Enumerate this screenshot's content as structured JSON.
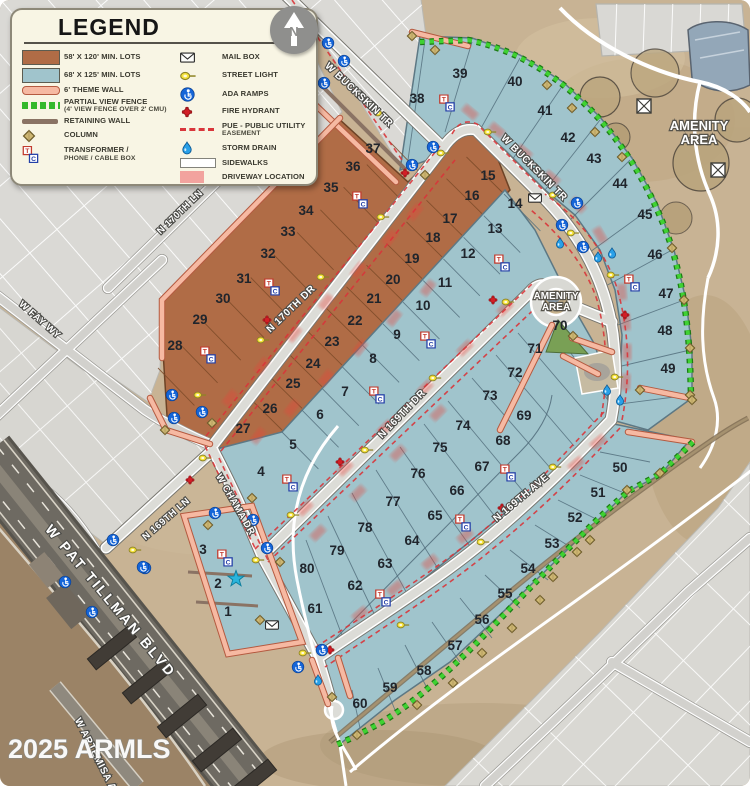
{
  "legend": {
    "title": "LEGEND",
    "left_items": [
      {
        "icon": "brown-swatch",
        "label": "58' X 120' MIN. LOTS"
      },
      {
        "icon": "blue-swatch",
        "label": "68' X 125' MIN. LOTS"
      },
      {
        "icon": "theme-wall",
        "label": "6' THEME WALL"
      },
      {
        "icon": "view-fence",
        "label": "PARTIAL VIEW FENCE",
        "label2": "(4' VIEW FENCE OVER 2' CMU)"
      },
      {
        "icon": "retaining-wall",
        "label": "RETAINING WALL"
      },
      {
        "icon": "column",
        "label": "COLUMN"
      },
      {
        "icon": "transformer-box",
        "label": "TRANSFORMER /",
        "label2": "PHONE / CABLE BOX"
      }
    ],
    "right_items": [
      {
        "icon": "mail-box",
        "label": "MAIL BOX"
      },
      {
        "icon": "street-light",
        "label": "STREET LIGHT"
      },
      {
        "icon": "ada-ramp",
        "label": "ADA RAMPS"
      },
      {
        "icon": "fire-hydrant",
        "label": "FIRE HYDRANT"
      },
      {
        "icon": "pue-dash",
        "label": "PUE - PUBLIC UTILITY",
        "label2": "EASEMENT"
      },
      {
        "icon": "storm-drain",
        "label": "STORM DRAIN"
      },
      {
        "icon": "sidewalks",
        "label": "SIDEWALKS"
      },
      {
        "icon": "driveway",
        "label": "DRIVEWAY LOCATION"
      }
    ]
  },
  "north": {
    "label": "N"
  },
  "watermark": {
    "text": "2025 ARMLS"
  },
  "map": {
    "street_labels": [
      {
        "text": "W BUCKSKIN TR",
        "x": 357,
        "y": 97,
        "rot": 43,
        "size": 10
      },
      {
        "text": "W BUCKSKIN TR",
        "x": 532,
        "y": 170,
        "rot": 45,
        "size": 10
      },
      {
        "text": "N 170TH LN",
        "x": 182,
        "y": 214,
        "rot": -44,
        "size": 9.5
      },
      {
        "text": "W FAY WY",
        "x": 38,
        "y": 322,
        "rot": 41,
        "size": 9.5
      },
      {
        "text": "N 170TH DR",
        "x": 293,
        "y": 311,
        "rot": -44,
        "size": 10
      },
      {
        "text": "N 169TH DR",
        "x": 404,
        "y": 416,
        "rot": -46,
        "size": 10
      },
      {
        "text": "N 169TH AVE",
        "x": 523,
        "y": 500,
        "rot": -40,
        "size": 10
      },
      {
        "text": "N 169TH LN",
        "x": 168,
        "y": 521,
        "rot": -41,
        "size": 9.5
      },
      {
        "text": "W CHAMA DR",
        "x": 233,
        "y": 506,
        "rot": 60,
        "size": 9.5
      },
      {
        "text": "W PAT TILLMAN BLVD",
        "x": 107,
        "y": 604,
        "rot": 50,
        "size": 14,
        "spacing": 2.5
      },
      {
        "text": "W ARTEMISA AVE",
        "x": 96,
        "y": 762,
        "rot": 63,
        "size": 10
      }
    ],
    "area_labels": [
      {
        "line1": "AMENITY",
        "line2": "AREA",
        "x": 699,
        "y": 130,
        "size": 13
      },
      {
        "line1": "AMENITY",
        "line2": "AREA",
        "x": 556,
        "y": 299,
        "size": 10
      }
    ],
    "lots": [
      {
        "n": "1",
        "x": 228,
        "y": 616
      },
      {
        "n": "2",
        "x": 218,
        "y": 588
      },
      {
        "n": "3",
        "x": 203,
        "y": 554
      },
      {
        "n": "4",
        "x": 261,
        "y": 476
      },
      {
        "n": "5",
        "x": 293,
        "y": 449
      },
      {
        "n": "6",
        "x": 320,
        "y": 419
      },
      {
        "n": "7",
        "x": 345,
        "y": 396
      },
      {
        "n": "8",
        "x": 373,
        "y": 363
      },
      {
        "n": "9",
        "x": 397,
        "y": 339
      },
      {
        "n": "10",
        "x": 423,
        "y": 310
      },
      {
        "n": "11",
        "x": 445,
        "y": 287
      },
      {
        "n": "12",
        "x": 468,
        "y": 258
      },
      {
        "n": "13",
        "x": 495,
        "y": 233
      },
      {
        "n": "14",
        "x": 515,
        "y": 208
      },
      {
        "n": "15",
        "x": 488,
        "y": 180
      },
      {
        "n": "16",
        "x": 472,
        "y": 200
      },
      {
        "n": "17",
        "x": 450,
        "y": 223
      },
      {
        "n": "18",
        "x": 433,
        "y": 242
      },
      {
        "n": "19",
        "x": 412,
        "y": 263
      },
      {
        "n": "20",
        "x": 393,
        "y": 284
      },
      {
        "n": "21",
        "x": 374,
        "y": 303
      },
      {
        "n": "22",
        "x": 355,
        "y": 325
      },
      {
        "n": "23",
        "x": 332,
        "y": 346
      },
      {
        "n": "24",
        "x": 313,
        "y": 368
      },
      {
        "n": "25",
        "x": 293,
        "y": 388
      },
      {
        "n": "26",
        "x": 270,
        "y": 413
      },
      {
        "n": "27",
        "x": 243,
        "y": 433
      },
      {
        "n": "28",
        "x": 175,
        "y": 350
      },
      {
        "n": "29",
        "x": 200,
        "y": 324
      },
      {
        "n": "30",
        "x": 223,
        "y": 303
      },
      {
        "n": "31",
        "x": 244,
        "y": 283
      },
      {
        "n": "32",
        "x": 268,
        "y": 258
      },
      {
        "n": "33",
        "x": 288,
        "y": 236
      },
      {
        "n": "34",
        "x": 306,
        "y": 215
      },
      {
        "n": "35",
        "x": 331,
        "y": 192
      },
      {
        "n": "36",
        "x": 353,
        "y": 171
      },
      {
        "n": "37",
        "x": 373,
        "y": 153
      },
      {
        "n": "38",
        "x": 417,
        "y": 103
      },
      {
        "n": "39",
        "x": 460,
        "y": 78
      },
      {
        "n": "40",
        "x": 515,
        "y": 86
      },
      {
        "n": "41",
        "x": 545,
        "y": 115
      },
      {
        "n": "42",
        "x": 568,
        "y": 142
      },
      {
        "n": "43",
        "x": 594,
        "y": 163
      },
      {
        "n": "44",
        "x": 620,
        "y": 188
      },
      {
        "n": "45",
        "x": 645,
        "y": 219
      },
      {
        "n": "46",
        "x": 655,
        "y": 259
      },
      {
        "n": "47",
        "x": 666,
        "y": 298
      },
      {
        "n": "48",
        "x": 665,
        "y": 335
      },
      {
        "n": "49",
        "x": 668,
        "y": 373
      },
      {
        "n": "50",
        "x": 620,
        "y": 472
      },
      {
        "n": "51",
        "x": 598,
        "y": 497
      },
      {
        "n": "52",
        "x": 575,
        "y": 522
      },
      {
        "n": "53",
        "x": 552,
        "y": 548
      },
      {
        "n": "54",
        "x": 528,
        "y": 573
      },
      {
        "n": "55",
        "x": 505,
        "y": 598
      },
      {
        "n": "56",
        "x": 482,
        "y": 624
      },
      {
        "n": "57",
        "x": 455,
        "y": 650
      },
      {
        "n": "58",
        "x": 424,
        "y": 675
      },
      {
        "n": "59",
        "x": 390,
        "y": 692
      },
      {
        "n": "60",
        "x": 360,
        "y": 708
      },
      {
        "n": "61",
        "x": 315,
        "y": 613
      },
      {
        "n": "62",
        "x": 355,
        "y": 590
      },
      {
        "n": "63",
        "x": 385,
        "y": 568
      },
      {
        "n": "64",
        "x": 412,
        "y": 545
      },
      {
        "n": "65",
        "x": 435,
        "y": 520
      },
      {
        "n": "66",
        "x": 457,
        "y": 495
      },
      {
        "n": "67",
        "x": 482,
        "y": 471
      },
      {
        "n": "68",
        "x": 503,
        "y": 445
      },
      {
        "n": "69",
        "x": 524,
        "y": 420
      },
      {
        "n": "70",
        "x": 560,
        "y": 330
      },
      {
        "n": "71",
        "x": 535,
        "y": 353
      },
      {
        "n": "72",
        "x": 515,
        "y": 377
      },
      {
        "n": "73",
        "x": 490,
        "y": 400
      },
      {
        "n": "74",
        "x": 463,
        "y": 430
      },
      {
        "n": "75",
        "x": 440,
        "y": 452
      },
      {
        "n": "76",
        "x": 418,
        "y": 478
      },
      {
        "n": "77",
        "x": 393,
        "y": 506
      },
      {
        "n": "78",
        "x": 365,
        "y": 532
      },
      {
        "n": "79",
        "x": 337,
        "y": 555
      },
      {
        "n": "80",
        "x": 307,
        "y": 573
      }
    ],
    "icons": {
      "columns": [
        [
          412,
          36
        ],
        [
          435,
          50
        ],
        [
          547,
          85
        ],
        [
          572,
          108
        ],
        [
          595,
          132
        ],
        [
          622,
          157
        ],
        [
          672,
          248
        ],
        [
          684,
          300
        ],
        [
          690,
          348
        ],
        [
          690,
          395
        ],
        [
          660,
          473
        ],
        [
          627,
          490
        ],
        [
          590,
          540
        ],
        [
          577,
          552
        ],
        [
          553,
          577
        ],
        [
          540,
          600
        ],
        [
          512,
          628
        ],
        [
          482,
          653
        ],
        [
          453,
          683
        ],
        [
          417,
          705
        ],
        [
          357,
          735
        ],
        [
          212,
          423
        ],
        [
          208,
          525
        ],
        [
          252,
          498
        ],
        [
          280,
          562
        ],
        [
          260,
          620
        ],
        [
          425,
          175
        ],
        [
          573,
          336
        ],
        [
          640,
          390
        ],
        [
          692,
          400
        ],
        [
          165,
          430
        ],
        [
          332,
          697
        ]
      ],
      "street_lights": [
        [
          380,
          113
        ],
        [
          443,
          153
        ],
        [
          490,
          132
        ],
        [
          555,
          195
        ],
        [
          573,
          233
        ],
        [
          613,
          275
        ],
        [
          617,
          377
        ],
        [
          508,
          302
        ],
        [
          435,
          378
        ],
        [
          383,
          217
        ],
        [
          323,
          277
        ],
        [
          263,
          340
        ],
        [
          200,
          395
        ],
        [
          205,
          458
        ],
        [
          135,
          550
        ],
        [
          258,
          560
        ],
        [
          293,
          515
        ],
        [
          367,
          450
        ],
        [
          305,
          653
        ],
        [
          403,
          625
        ],
        [
          555,
          467
        ],
        [
          483,
          542
        ]
      ],
      "ada_ramps": [
        [
          328,
          43
        ],
        [
          344,
          61
        ],
        [
          324,
          83
        ],
        [
          433,
          147
        ],
        [
          412,
          165
        ],
        [
          577,
          203
        ],
        [
          562,
          225
        ],
        [
          583,
          247
        ],
        [
          172,
          395
        ],
        [
          174,
          418
        ],
        [
          202,
          412
        ],
        [
          215,
          513
        ],
        [
          253,
          520
        ],
        [
          267,
          548
        ],
        [
          145,
          568
        ],
        [
          65,
          582
        ],
        [
          92,
          612
        ],
        [
          113,
          540
        ],
        [
          143,
          567
        ],
        [
          322,
          650
        ],
        [
          298,
          667
        ]
      ],
      "fire_hydrants": [
        [
          405,
          173
        ],
        [
          493,
          300
        ],
        [
          625,
          315
        ],
        [
          267,
          320
        ],
        [
          190,
          480
        ],
        [
          340,
          462
        ],
        [
          330,
          650
        ],
        [
          502,
          508
        ]
      ],
      "tc_boxes": [
        [
          447,
          103
        ],
        [
          502,
          263
        ],
        [
          632,
          283
        ],
        [
          428,
          340
        ],
        [
          360,
          200
        ],
        [
          272,
          287
        ],
        [
          208,
          355
        ],
        [
          290,
          483
        ],
        [
          225,
          558
        ],
        [
          383,
          598
        ],
        [
          377,
          395
        ],
        [
          463,
          523
        ],
        [
          508,
          473
        ]
      ],
      "mailboxes": [
        [
          535,
          198
        ],
        [
          272,
          625
        ]
      ],
      "storm_drains": [
        [
          598,
          257
        ],
        [
          612,
          253
        ],
        [
          607,
          390
        ],
        [
          620,
          400
        ],
        [
          318,
          680
        ],
        [
          560,
          243
        ]
      ],
      "star": [
        236,
        579
      ]
    },
    "colors": {
      "lot_brown": "#b06c46",
      "lot_blue": "#a0c4cc",
      "theme_wall": "#f6b9a2",
      "view_fence": "#35b92c",
      "retaining_wall": "#8a7364",
      "pue_red": "#d9363b",
      "driveway_pink": "#f2a39e"
    }
  }
}
